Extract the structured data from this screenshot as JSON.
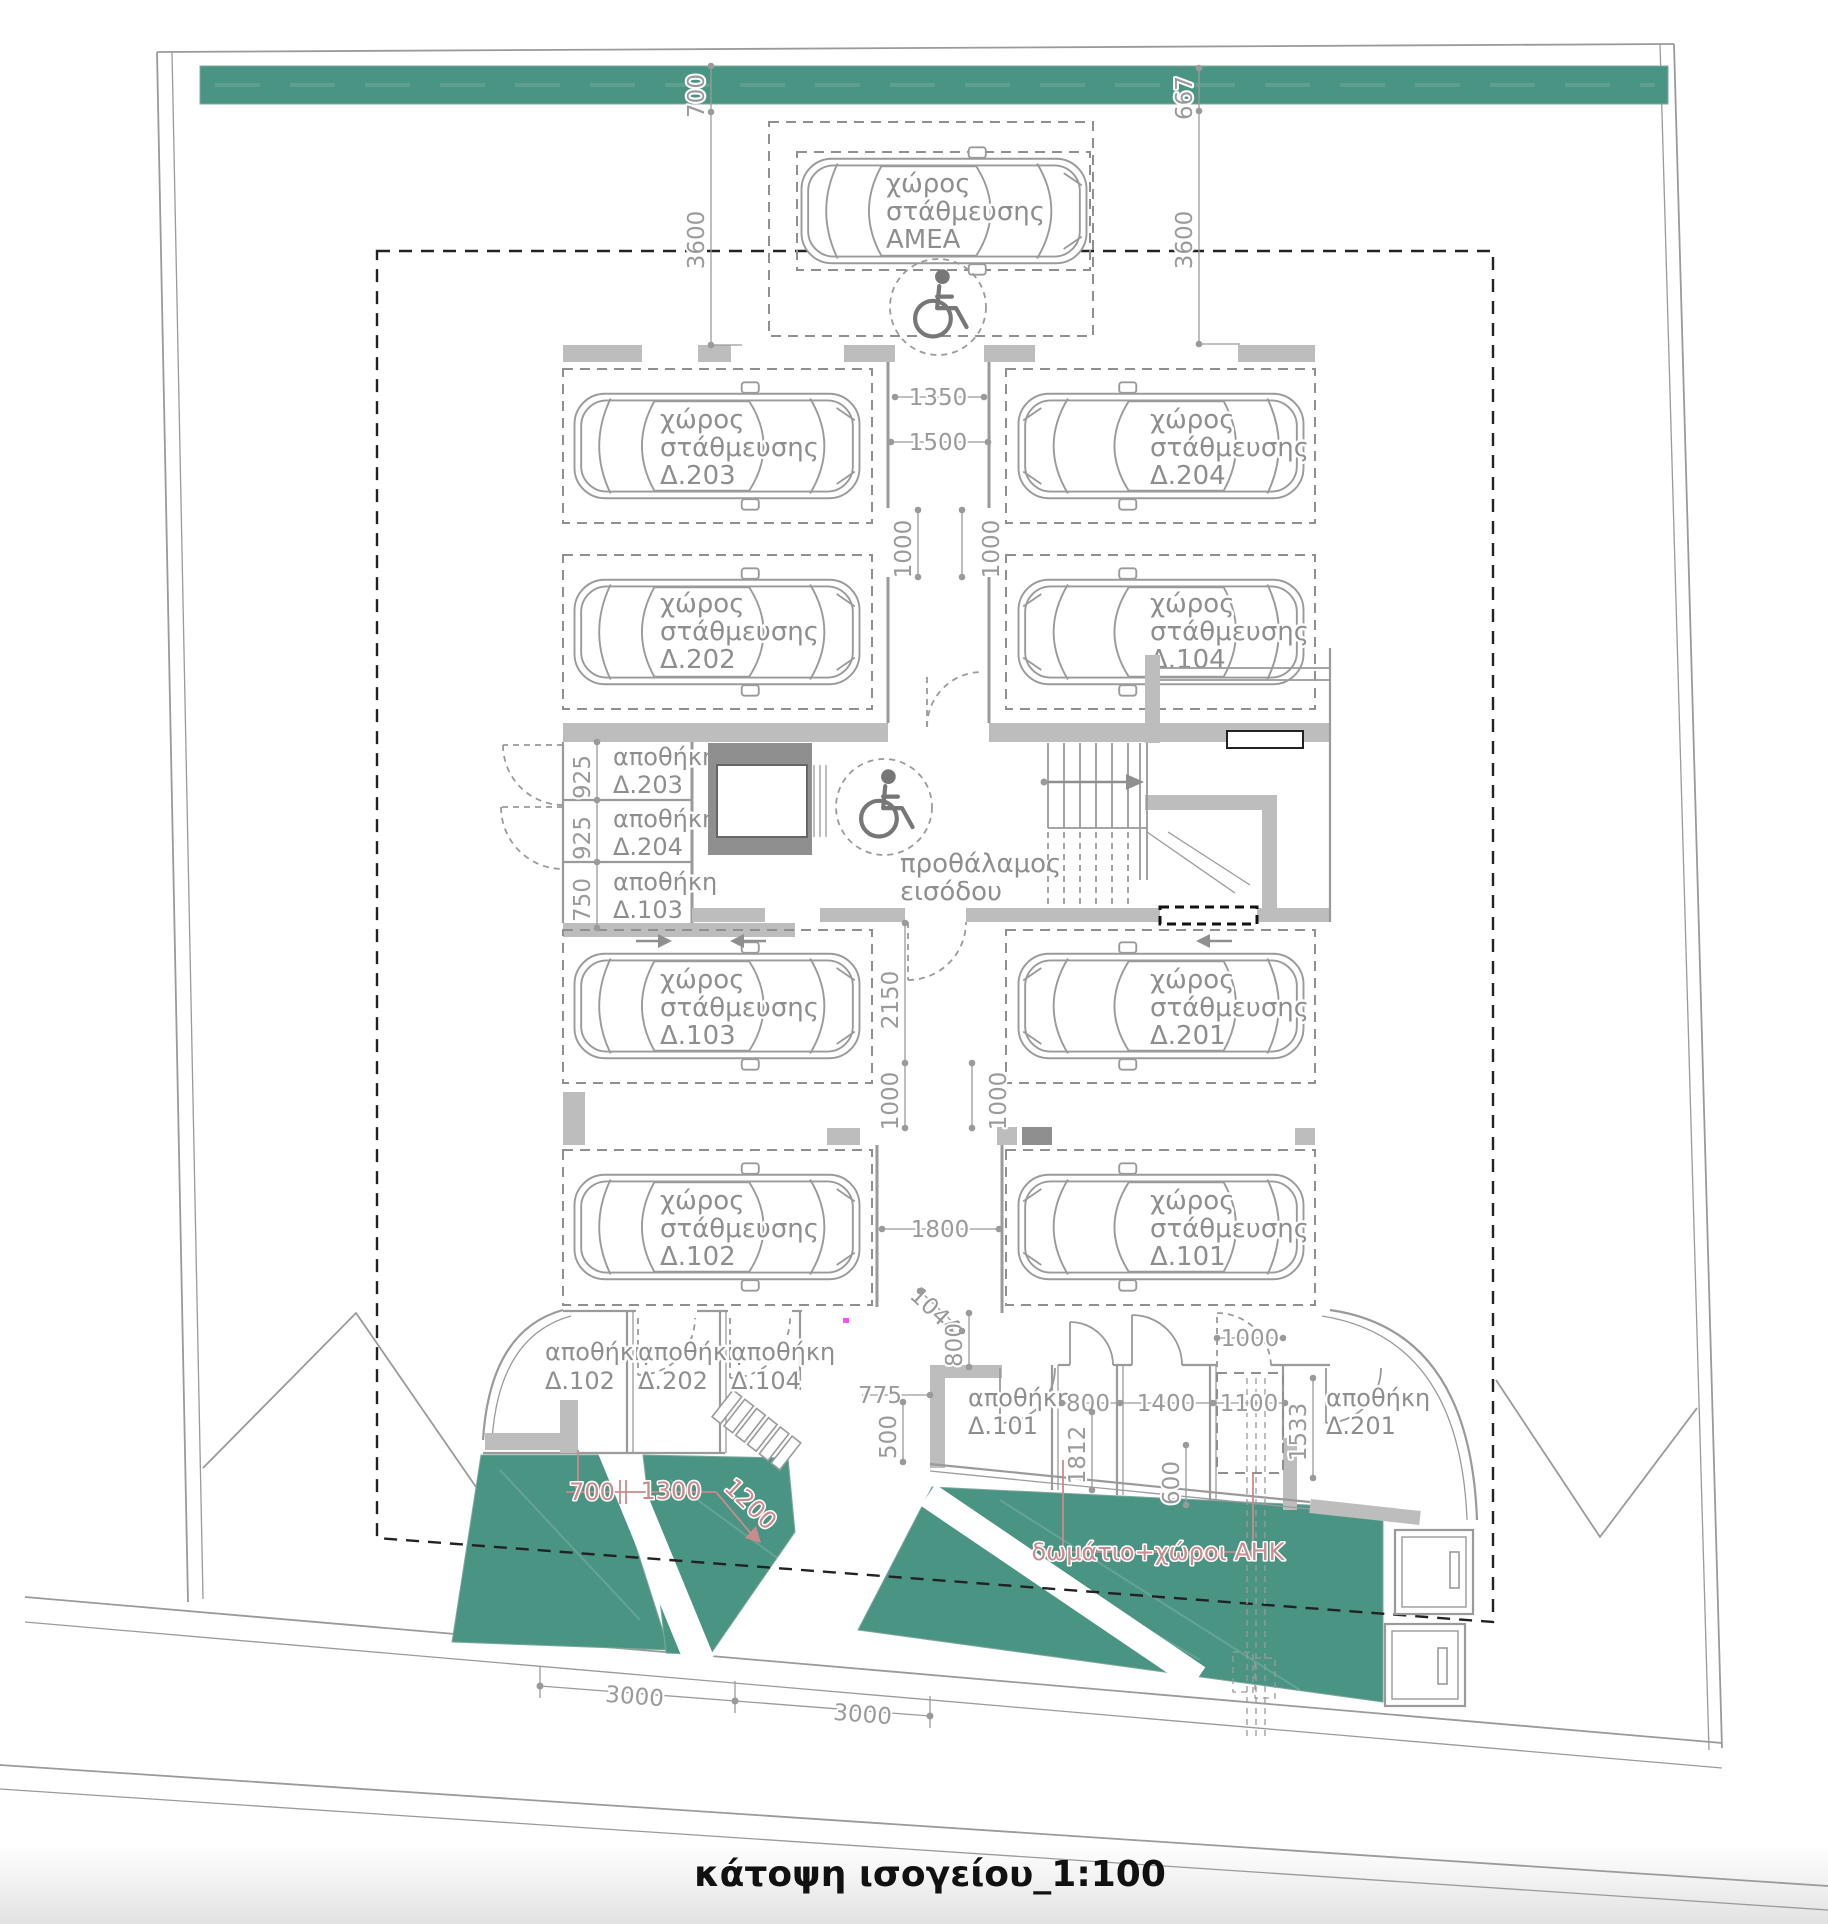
{
  "title": "κάτοψη ισογείου_1:100",
  "colors": {
    "green": "#4a9484",
    "wall_light": "#bdbdbd",
    "wall_dark": "#8f8f8f",
    "line": "#9a9a9a",
    "text": "#8e8e8e",
    "dim": "#9a9a9a",
    "red": "#c98b8b",
    "envelope": "#222222",
    "title": "#111111"
  },
  "text": {
    "parking_line1": "χώρος",
    "parking_line2": "στάθμευσης",
    "amea": "ΑΜΕΑ",
    "storage": "αποθήκη",
    "vestibule_line1": "προθάλαμος",
    "vestibule_line2": "εισόδου",
    "ahk_label": "δωμάτιο+χώροι ΑΗΚ"
  },
  "units": {
    "p203": "Δ.203",
    "p204": "Δ.204",
    "p202": "Δ.202",
    "p104": "Δ.104",
    "p103": "Δ.103",
    "p201": "Δ.201",
    "p102": "Δ.102",
    "p101": "Δ.101",
    "s203": "Δ.203",
    "s204": "Δ.204",
    "s103": "Δ.103",
    "s102": "Δ.102",
    "s202": "Δ.202",
    "s104": "Δ.104",
    "s101": "Δ.101",
    "s201": "Δ.201"
  },
  "dims": {
    "d700": "700",
    "d3600": "3600",
    "d667": "667",
    "d1350": "1350",
    "d1500": "1500",
    "d1000": "1000",
    "d925": "925",
    "d750": "750",
    "d2150": "2150",
    "d1800": "1800",
    "d1044": "1044",
    "d800": "800",
    "d775": "775",
    "d500": "500",
    "d1300": "1300",
    "d1200": "1200",
    "d1812": "1812",
    "d1400": "1400",
    "d1100": "1100",
    "d600": "600",
    "d1533": "1533",
    "d3000": "3000"
  }
}
